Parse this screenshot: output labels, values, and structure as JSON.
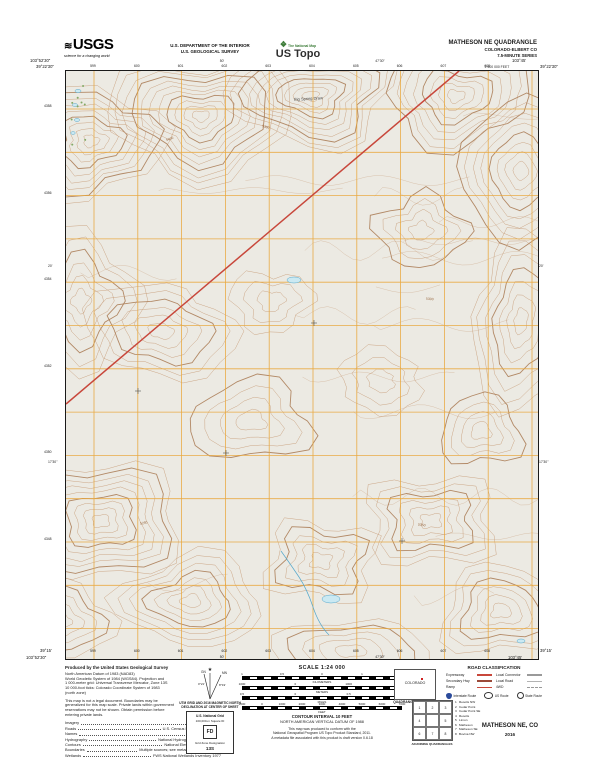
{
  "header": {
    "usgs_logo": "USGS",
    "usgs_tagline": "science for a changing world",
    "dept_line1": "U.S. DEPARTMENT OF THE INTERIOR",
    "dept_line2": "U.S. GEOLOGICAL SURVEY",
    "ustopo_tagline": "The National Map",
    "ustopo_brand": "US Topo",
    "quad_title": "MATHESON NE QUADRANGLE",
    "quad_state": "COLORADO-ELBERT CO",
    "quad_series": "7.5-MINUTE SERIES"
  },
  "map": {
    "corners": {
      "nw_lon": "103°52'30\"",
      "nw_lat": "39°22'30\"",
      "ne_lon": "103°45'",
      "ne_lat": "39°22'30\"",
      "sw_lat": "39°15'",
      "sw_lon": "103°52'30\"",
      "se_lat": "39°15'",
      "se_lon": "103°45'"
    },
    "edge": {
      "top_mid_lons": [
        "50'",
        "47'30\""
      ],
      "bottom_mid_lons": [
        "50'",
        "47'30\""
      ],
      "left_mid_lats": [
        "20'",
        "17'30\""
      ],
      "right_mid_lats": [
        "20'",
        "17'30\""
      ],
      "top_utm": [
        "599",
        "600",
        "601",
        "602",
        "603",
        "604",
        "605",
        "606",
        "607",
        "608"
      ],
      "bottom_utm": [
        "599",
        "600",
        "601",
        "602",
        "603",
        "604",
        "605",
        "606",
        "607",
        "608"
      ],
      "left_utm": [
        "4358",
        "4356",
        "4354",
        "4352",
        "4350",
        "4348"
      ],
      "feet_note": "2 600 000 FEET"
    },
    "labels": {
      "feature": "Big Spring Draw",
      "contour_values": [
        "5400",
        "5380",
        "5300",
        "5250",
        "5350"
      ]
    }
  },
  "footer": {
    "produced_by": "Produced by the United States Geological Survey",
    "datum_lines": [
      "North American Datum of 1983 (NAD83)",
      "World Geodetic System of 1984 (WGS84). Projection and",
      "1 000-meter grid: Universal Transverse Mercator, Zone 13S",
      "10 000-foot ticks: Colorado Coordinate System of 1983",
      "(north zone)"
    ],
    "legal_lines": [
      "This map is not a legal document. Boundaries may be",
      "generalized for this map scale. Private lands within government",
      "reservations may not be shown. Obtain permission before",
      "entering private lands."
    ],
    "sources": [
      {
        "label": "Imagery",
        "value": "NAIP, July 2015"
      },
      {
        "label": "Roads",
        "value": "U.S. Census Bureau, 2015 - 2016"
      },
      {
        "label": "Names",
        "value": "GNIS, 2016"
      },
      {
        "label": "Hydrography",
        "value": "National Hydrography Dataset, 2015"
      },
      {
        "label": "Contours",
        "value": "National Elevation Dataset, 2015"
      },
      {
        "label": "Boundaries",
        "value": "Multiple sources; see metadata file 2015 - 2016"
      },
      {
        "label": "Wetlands",
        "value": "FWS National Wetlands Inventory 1977"
      }
    ],
    "declination": {
      "gn_label": "GN",
      "mn_label": "MN",
      "gn_angle": "0°21'",
      "mn_angle": "8°19'",
      "caption_line1": "UTM GRID AND 2016 MAGNETIC NORTH",
      "caption_line2": "DECLINATION AT CENTER OF SHEET"
    },
    "usng": {
      "title": "U.S. National Grid",
      "subtitle": "100,000-m Square ID",
      "square_id": "FD",
      "zone_label": "Grid Zone Designation",
      "zone": "13S"
    },
    "scale": {
      "title": "SCALE 1:24 000",
      "bars": [
        {
          "unit": "KILOMETERS",
          "marks": [
            "1",
            "0.5",
            "0",
            "1",
            "2"
          ]
        },
        {
          "unit": "METERS",
          "marks": [
            "1000",
            "0",
            "1000",
            "2000"
          ]
        },
        {
          "unit": "MILES",
          "marks": [
            "0.5",
            "0",
            "0.5",
            "1"
          ]
        },
        {
          "unit": "FEET",
          "marks": [
            "1000",
            "0",
            "1000",
            "2000",
            "3000",
            "4000",
            "5000",
            "6000",
            "7000"
          ]
        }
      ]
    },
    "contour_interval_line1": "CONTOUR INTERVAL 10 FEET",
    "contour_interval_line2": "NORTH AMERICAN VERTICAL DATUM OF 1988",
    "standard_lines": [
      "This map was produced to conform with the",
      "National Geospatial Program US Topo Product Standard, 2011.",
      "A metadata file associated with this product is draft version 0.6.18"
    ],
    "quad_location": {
      "state": "COLORADO",
      "caption": "QUADRANGLE LOCATION"
    },
    "road_classification": {
      "title": "ROAD CLASSIFICATION",
      "left_rows": [
        "Expressway",
        "Secondary Hwy",
        "Ramp"
      ],
      "right_rows": [
        "Local Connector",
        "Local Road",
        "4WD"
      ],
      "route_types": [
        "Interstate Route",
        "US Route",
        "State Route"
      ]
    },
    "adjoining": {
      "caption": "ADJOINING QUADRANGLES",
      "numbers": [
        "1",
        "2",
        "3",
        "4",
        "5",
        "6",
        "7",
        "8"
      ],
      "names": [
        "Resolis NW",
        "Cedar Point",
        "Cedar Point SE",
        "Resolis",
        "Limon",
        "Matheson",
        "Matheson SE",
        "Bovina NW"
      ]
    },
    "map_name": "MATHESON NE, CO",
    "map_year": "2016"
  }
}
